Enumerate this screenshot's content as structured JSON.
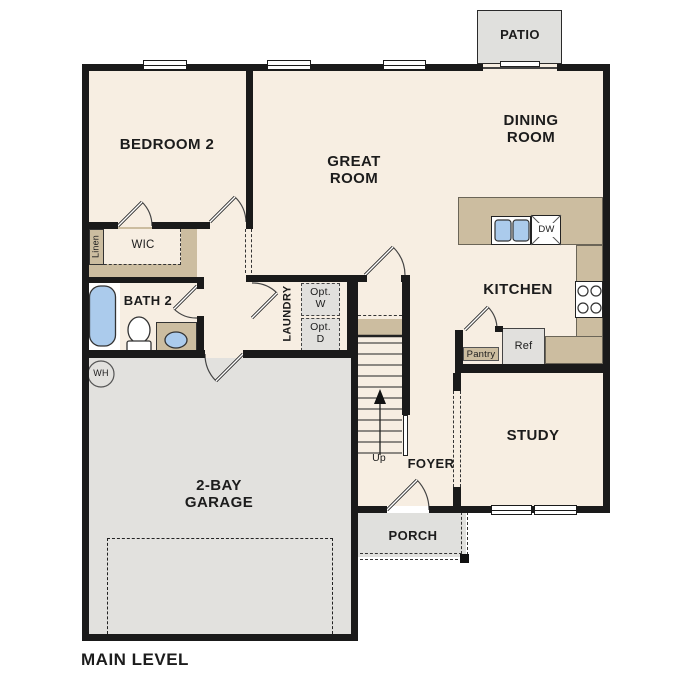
{
  "title": "MAIN LEVEL",
  "rooms": {
    "patio": "PATIO",
    "bedroom2": "BEDROOM 2",
    "great_line1": "GREAT",
    "great_line2": "ROOM",
    "dining_line1": "DINING",
    "dining_line2": "ROOM",
    "kitchen": "KITCHEN",
    "study": "STUDY",
    "foyer": "FOYER",
    "porch": "PORCH",
    "garage_line1": "2-BAY",
    "garage_line2": "GARAGE",
    "bath2": "BATH 2",
    "wic": "WIC",
    "linen": "Linen",
    "laundry": "LAUNDRY"
  },
  "fixtures": {
    "opt_w_line1": "Opt.",
    "opt_w_line2": "W",
    "opt_d_line1": "Opt.",
    "opt_d_line2": "D",
    "pantry": "Pantry",
    "ref": "Ref",
    "dw": "DW",
    "wh": "WH",
    "up": "Up"
  },
  "colors": {
    "wall": "#1a1a1a",
    "room_fill": "#f7eee2",
    "counter_tan": "#ccbda0",
    "garage_gray": "#e2e1de",
    "patio_gray": "#e0e0dd",
    "appliance_gray": "#e1e0dd",
    "fixture_blue": "#abcbec"
  }
}
